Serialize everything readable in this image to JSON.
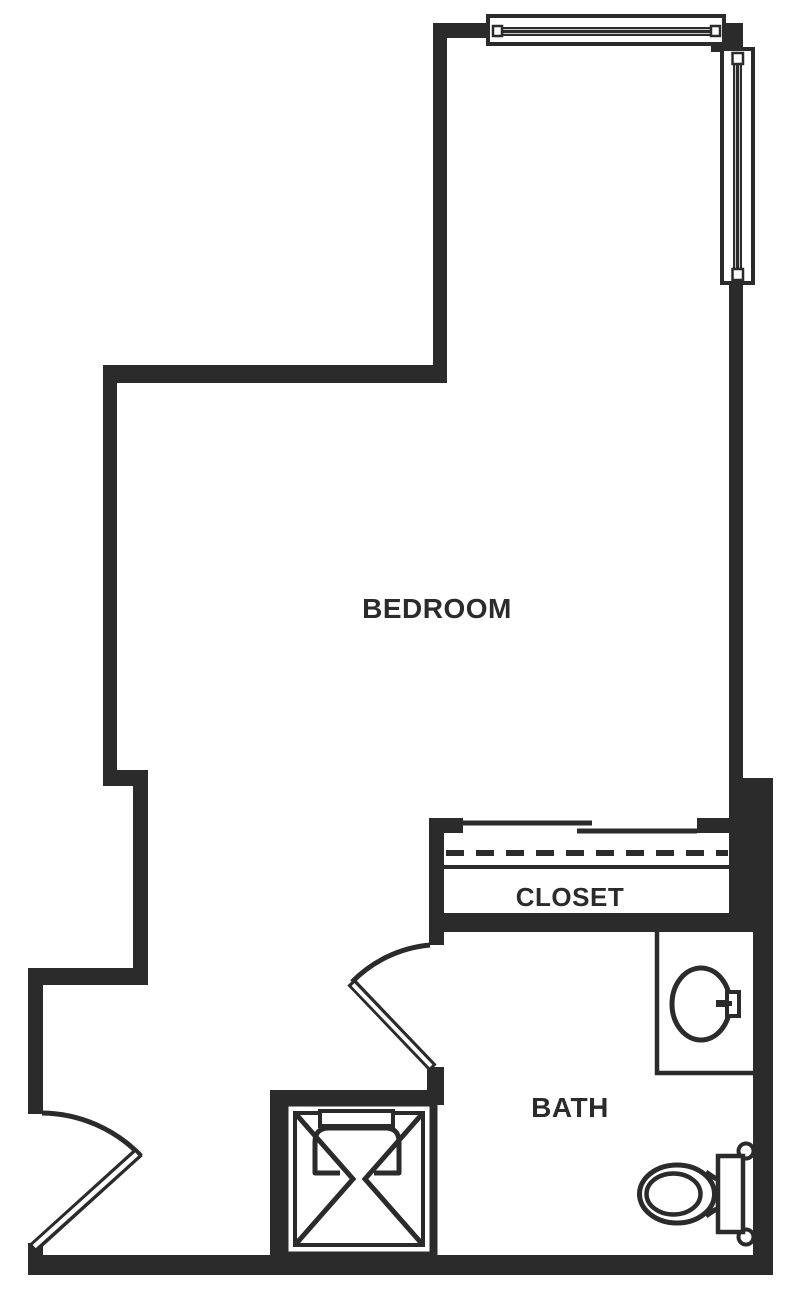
{
  "floor_plan": {
    "labels": {
      "bedroom": "BEDROOM",
      "closet": "CLOSET",
      "bath": "BATH"
    },
    "colors": {
      "wall": "#2b2b2b",
      "floor": "#ffffff"
    },
    "fixtures": [
      "top-window",
      "right-window",
      "sliding-closet-doors",
      "closet-rod",
      "closet-shelf",
      "entry-swing-door",
      "bath-swing-door",
      "shower-stall",
      "vanity-sink",
      "toilet"
    ]
  }
}
